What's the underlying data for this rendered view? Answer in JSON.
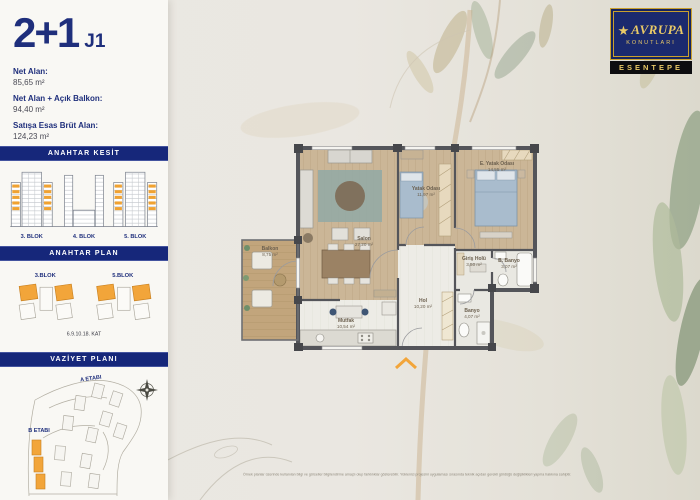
{
  "unit": {
    "type": "2+1",
    "code": "J1",
    "areas": [
      {
        "label": "Net Alan:",
        "value": "85,65 m²"
      },
      {
        "label": "Net Alan + Açık Balkon:",
        "value": "94,40 m²"
      },
      {
        "label": "Satışa Esas Brüt Alan:",
        "value": "124,23 m²"
      }
    ]
  },
  "sidebar": {
    "section_kesit": {
      "title": "ANAHTAR KESİT",
      "blocks": [
        {
          "label": "3. BLOK"
        },
        {
          "label": "4. BLOK"
        },
        {
          "label": "5. BLOK"
        }
      ]
    },
    "section_plan": {
      "title": "ANAHTAR PLAN",
      "blocks": [
        {
          "label": "3.BLOK"
        },
        {
          "label": "5.BLOK"
        }
      ],
      "caption": "6.9.10.18. KAT"
    },
    "section_vaziyet": {
      "title": "VAZİYET PLANI",
      "stage_a": "A ETABI",
      "stage_b": "B ETABI"
    }
  },
  "floorplan": {
    "rooms": [
      {
        "name": "Salon",
        "area": "27,20 m²"
      },
      {
        "name": "Yatak Odası",
        "area": "11,97 m²"
      },
      {
        "name": "E. Yatak Odası",
        "area": "14,55 m²"
      },
      {
        "name": "Mutfak",
        "area": "10,54 m²"
      },
      {
        "name": "Balkon",
        "area": "8,75 m²"
      },
      {
        "name": "Hol",
        "area": "10,20 m²"
      },
      {
        "name": "Giriş Holü",
        "area": "3,50 m²"
      },
      {
        "name": "Banyo",
        "area": "4,07 m²"
      },
      {
        "name": "B. Banyo",
        "area": "3,07 m²"
      }
    ]
  },
  "logo": {
    "brand_line1": "AVRUPA",
    "brand_line2": "KONUTLARI",
    "project": "ESENTEPE"
  },
  "footer": {
    "disclaimer": "Örnek planlar üzerinde kullanılan bilgi ve görseller bilgilendirme amaçlı olup farklılıklar gösterebilir. Yüklenici projesini uygulaması sırasında teknik açıdan gerekli gördüğü değişiklikleri yapma hakkına sahiptir."
  },
  "colors": {
    "navy": "#1a2a7c",
    "orange": "#f2a53a",
    "gold": "#c9a02e"
  }
}
